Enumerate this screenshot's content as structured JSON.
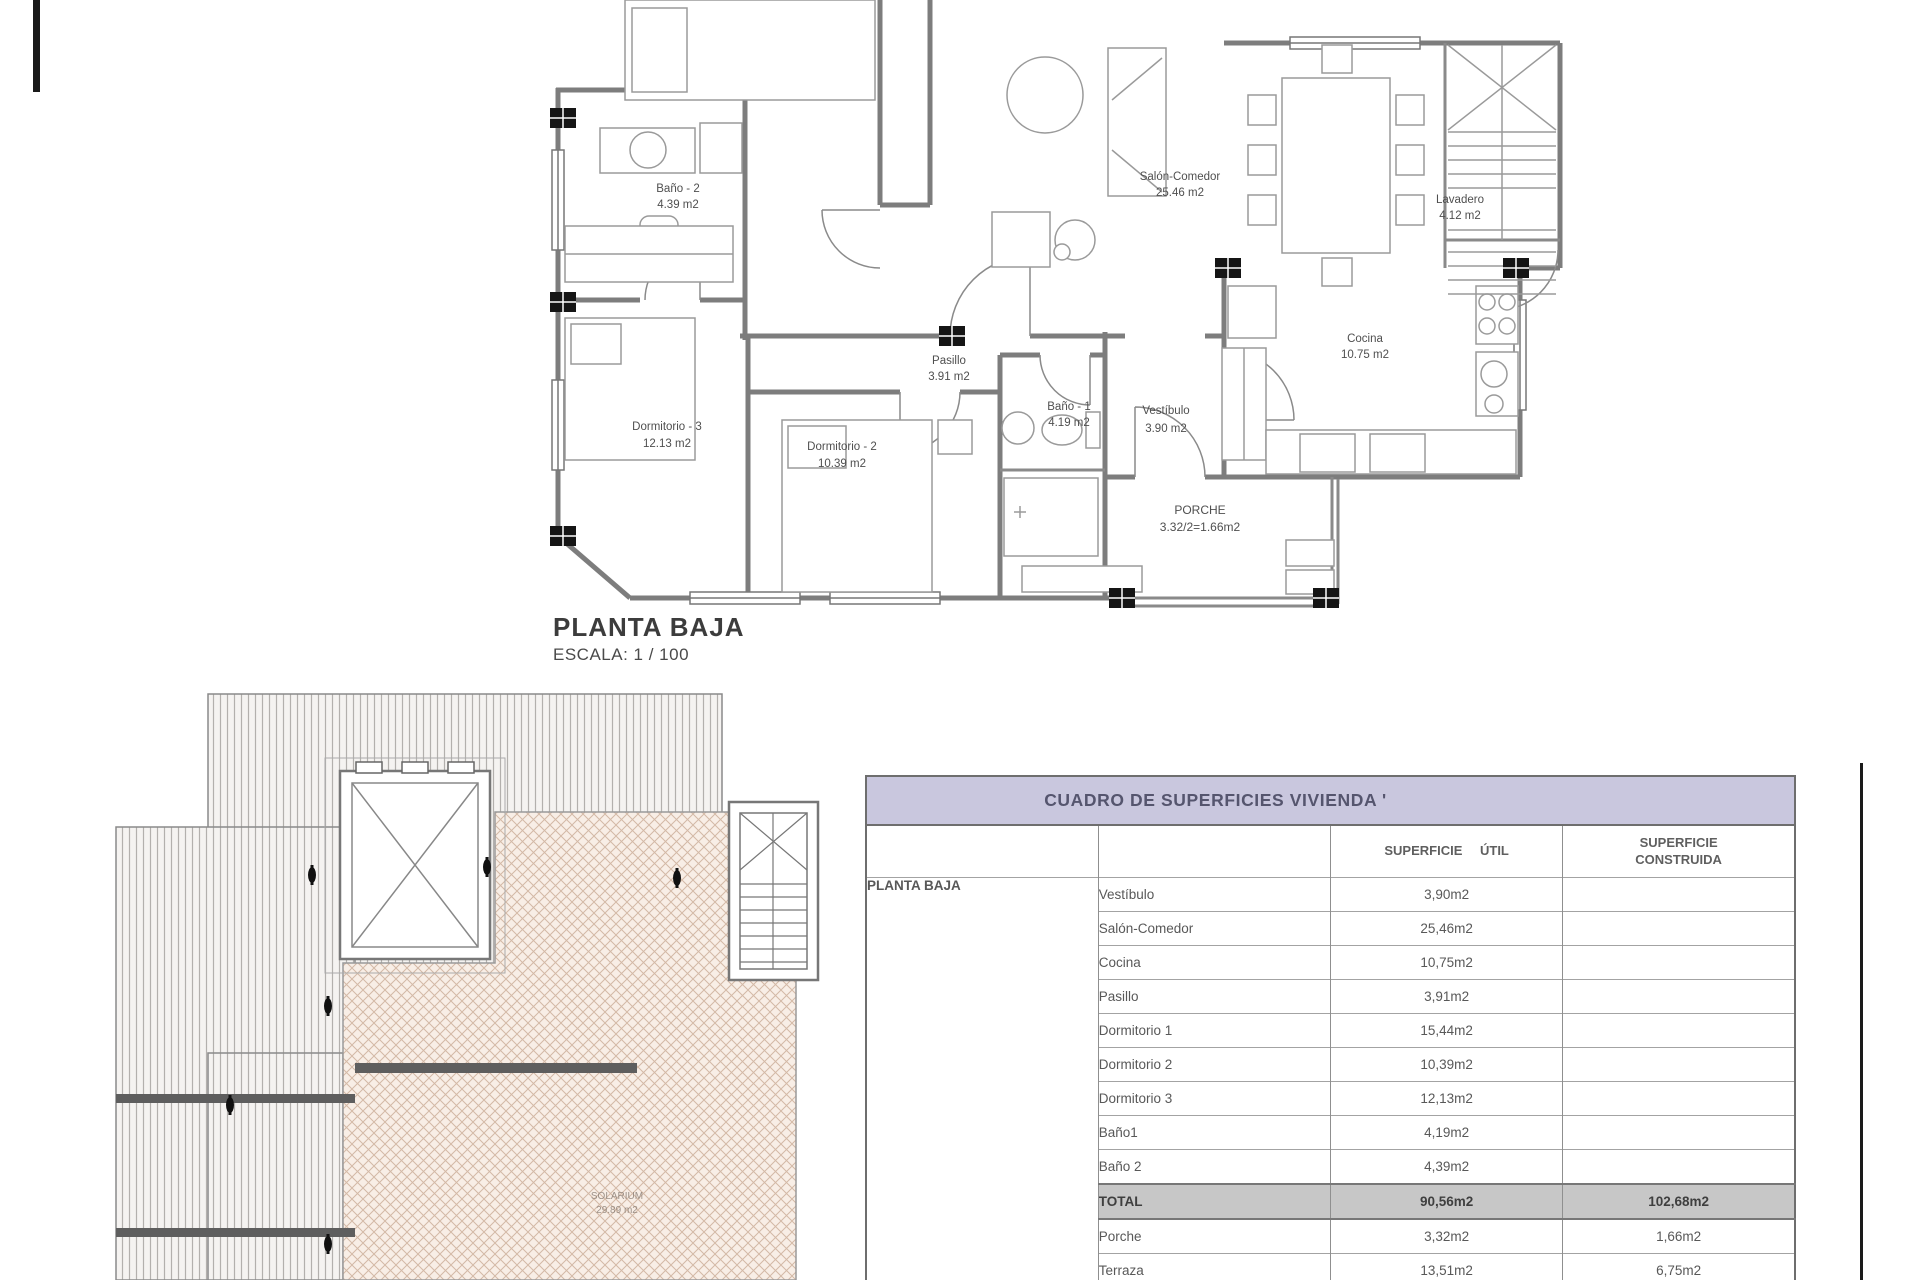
{
  "floor_plan": {
    "title": "PLANTA BAJA",
    "scale": "ESCALA: 1 / 100",
    "rooms": [
      {
        "name": "Baño - 2",
        "area": "4.39 m2"
      },
      {
        "name": "Salón-Comedor",
        "area": "25.46 m2"
      },
      {
        "name": "Pasillo",
        "area": "3.91 m2"
      },
      {
        "name": "Vestíbulo",
        "area": "3.90 m2"
      },
      {
        "name": "Cocina",
        "area": "10.75 m2"
      },
      {
        "name": "Dormitorio - 3",
        "area": "12.13 m2"
      },
      {
        "name": "Dormitorio - 2",
        "area": "10.39 m2"
      },
      {
        "name": "Baño - 1",
        "area": "4.19 m2"
      },
      {
        "name": "Lavadero",
        "area": "4.12 m2"
      },
      {
        "name": "PORCHE",
        "area": "3.32/2=1.66m2"
      }
    ]
  },
  "roof_plan": {
    "solarium_label": "SOLARIUM",
    "solarium_area": "29.89 m2"
  },
  "table": {
    "title": "CUADRO DE SUPERFICIES  VIVIENDA '",
    "col_util": "SUPERFICIE ÚTIL",
    "col_construida_1": "SUPERFICIE",
    "col_construida_2": "CONSTRUIDA",
    "row_group": "PLANTA BAJA",
    "rows": [
      {
        "name": "Vestíbulo",
        "util": "3,90m2",
        "construida": ""
      },
      {
        "name": "Salón-Comedor",
        "util": "25,46m2",
        "construida": ""
      },
      {
        "name": "Cocina",
        "util": "10,75m2",
        "construida": ""
      },
      {
        "name": "Pasillo",
        "util": "3,91m2",
        "construida": ""
      },
      {
        "name": "Dormitorio 1",
        "util": "15,44m2",
        "construida": ""
      },
      {
        "name": "Dormitorio 2",
        "util": "10,39m2",
        "construida": ""
      },
      {
        "name": "Dormitorio 3",
        "util": "12,13m2",
        "construida": ""
      },
      {
        "name": "Baño1",
        "util": "4,19m2",
        "construida": ""
      },
      {
        "name": "Baño 2",
        "util": "4,39m2",
        "construida": ""
      },
      {
        "name": "TOTAL",
        "util": "90,56m2",
        "construida": "102,68m2"
      },
      {
        "name": "Porche",
        "util": "3,32m2",
        "construida": "1,66m2"
      },
      {
        "name": "Terraza",
        "util": "13,51m2",
        "construida": "6,75m2"
      }
    ]
  },
  "colors": {
    "table_header_bg": "#c9c7de",
    "total_row_bg": "#c7c7c7",
    "wall_gray": "#7d7d7d",
    "solarium_fill": "#f8eee6"
  }
}
